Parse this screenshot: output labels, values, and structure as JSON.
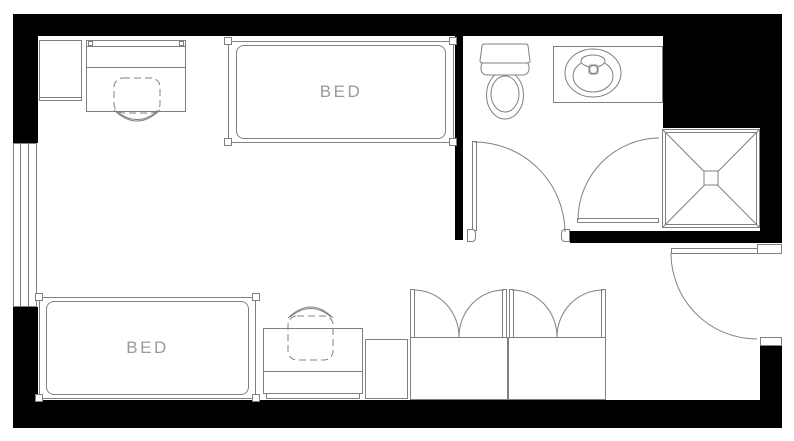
{
  "plan": {
    "beds": [
      {
        "label": "BED"
      },
      {
        "label": "BED"
      }
    ],
    "fixtures": [
      "desk",
      "desk-chair",
      "shelf-cabinet",
      "window",
      "toilet",
      "sink-counter",
      "shower",
      "dresser",
      "closet",
      "closet",
      "entry-door",
      "bathroom-door",
      "shower-door"
    ],
    "colors": {
      "wall": "#000000",
      "line": "#808080",
      "label": "#9a9a9a",
      "background": "#ffffff"
    }
  }
}
